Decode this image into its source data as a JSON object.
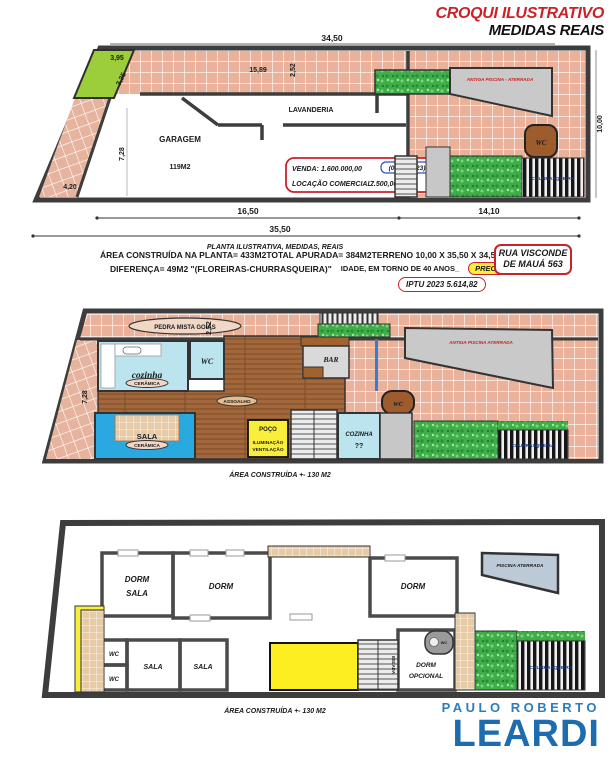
{
  "header": {
    "title": "CROQUI ILUSTRATIVO",
    "subtitle": "MEDIDAS REAIS"
  },
  "plan1": {
    "dim_3450": "34,50",
    "dim_395": "3,95",
    "dim_335": "3,35",
    "dim_1589": "15,89",
    "dim_252": "2,52",
    "dim_728": "7,28",
    "dim_420": "4,20",
    "dim_1000": "10,00",
    "dim_1650": "16,50",
    "dim_1410": "14,10",
    "dim_3550": "35,50",
    "garagem": "GARAGEM",
    "garagem_area": "119M2",
    "lavanderia": "LAVANDERIA",
    "venda_label": "VENDA:",
    "venda_value": "1.600.000,00",
    "venda_date": "(08/09/2023)",
    "locacao_label": "LOCAÇÃO COMERCIAL:",
    "locacao_value": "7.500,00",
    "wc": "WC",
    "antiga_piscina": "ANTIGA PISCINA - ATERRADA",
    "churrasqueira": "CHURRASQUEIRA",
    "caption": "PLANTA ILUSTRATIVA, MEDIDAS, REAIS"
  },
  "info": {
    "area_construida": "ÁREA CONSTRUÍDA NA PLANTA= 433M2",
    "total_apurada": "TOTAL APURADA= 384M2",
    "terreno": "TERRENO 10,00 X 35,50 X 34,50= 350 M²",
    "diferenca": "DIFERENÇA= 49M2 \"(FLOREIRAS-CHURRASQUEIRA)\"",
    "idade": "IDADE, EM TORNO DE 40 ANOS_",
    "reforma": "PRECISA DE REFORMA",
    "iptu": "IPTU 2023 5.614,82",
    "address1": "RUA VISCONDE",
    "address2": "DE MAUÁ 563"
  },
  "plan2": {
    "dim_252": "2,52",
    "dim_728": "7,28",
    "pedra": "PEDRA MISTA GOIÁS",
    "cozinha": "cozinha",
    "ceramica1": "CERÂMICA",
    "wc1": "WC",
    "bar": "BAR",
    "antiga_piscina": "ANTIGA PISCINA  ATERRADA",
    "assoalho": "ASSOALHO",
    "sala": "SALA",
    "ceramica2": "CERÂMICA",
    "poco_l1": "POÇO",
    "poco_l2": "ILUMINAÇÃO",
    "poco_l3": "VENTILAÇÃO",
    "wc2": "WC",
    "cozinha2_l1": "COZINHA",
    "cozinha2_l2": "??",
    "churrasqueira": "CHURRASQUEIRA",
    "caption": "ÁREA CONSTRUÍDA +- 130 M2"
  },
  "plan3": {
    "dorm_sala_l1": "DORM",
    "dorm_sala_l2": "SALA",
    "dorm2": "DORM",
    "dorm3": "DORM",
    "wc1": "WC",
    "wc2": "WC",
    "wc3": "WC",
    "sala1": "SALA",
    "sala2": "SALA",
    "piscina": "PISCINA ATERRADA",
    "escada": "ESCADA",
    "dorm_opcional_l1": "DORM",
    "dorm_opcional_l2": "OPCIONAL",
    "churrasqueira": "CHURRASQUEIRA",
    "caption": "ÁREA CONSTRUÍDA +- 130 M2"
  },
  "logo": {
    "line1": "PAULO ROBERTO",
    "line2": "LEARDI"
  },
  "colors": {
    "accent_red": "#cc2127",
    "logo_blue": "#1d6cb0",
    "tile_pink": "#eab29b",
    "grass_green": "#3fae49",
    "planter_green": "#9ccd3a",
    "highlight_yellow": "#f9ee3a",
    "wood_brown": "#a2683c",
    "ceramic_blue": "#bce4ef",
    "sala_blue": "#2aa9e0",
    "wc_brown": "#9e5b2d",
    "date_blue": "#1a3d8f"
  }
}
